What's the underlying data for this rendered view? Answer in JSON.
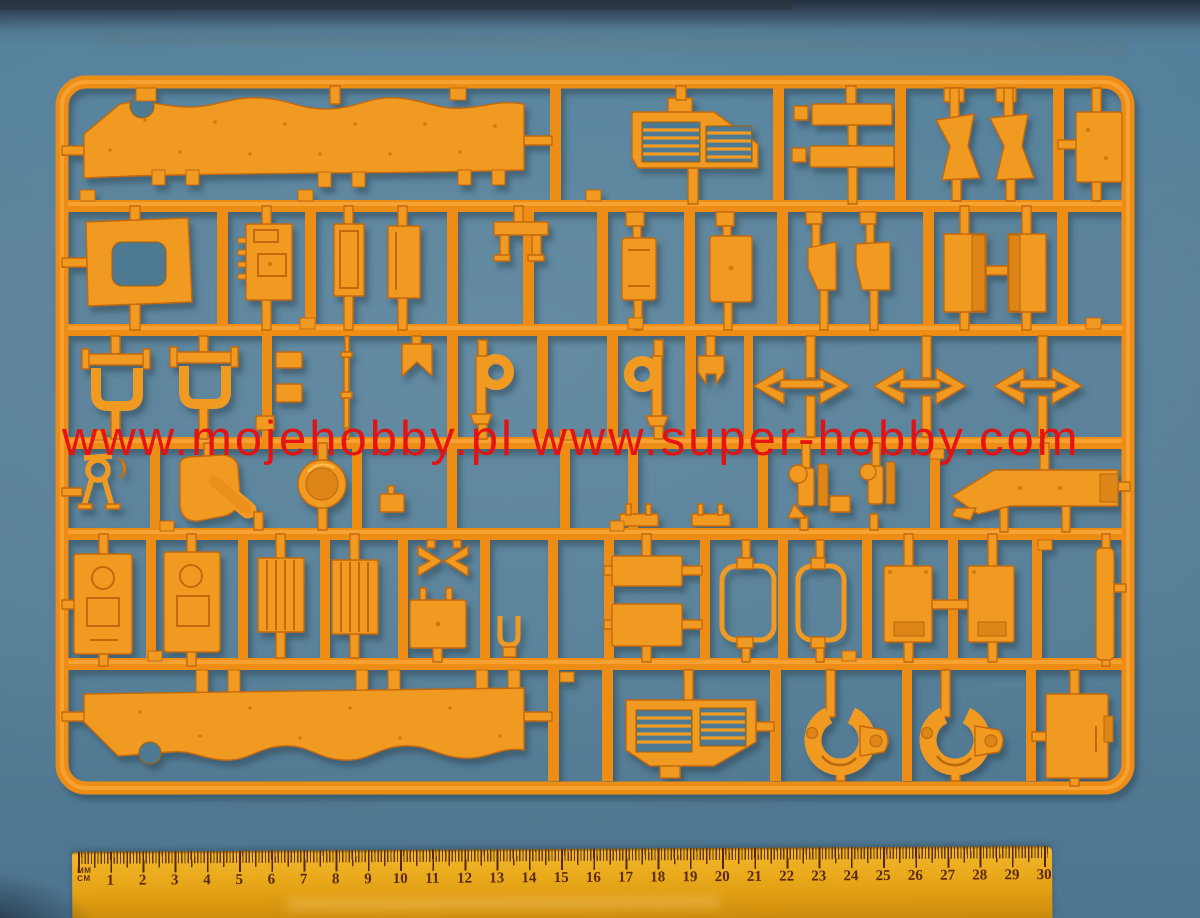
{
  "image_type": "photograph",
  "subject": "Orange plastic model kit sprue (injection-moulded parts frame) lying on a blue surface, photographed from above with a centimeter ruler at the bottom for scale",
  "colors": {
    "background_blue": "#54809a",
    "sprue_orange": "#ee8d18",
    "part_orange": "#f19a24",
    "watermark_red": "#e51111",
    "ruler_yellow": "#e7a61a",
    "ruler_markings": "#5c2a12"
  },
  "watermark": {
    "text": "www.mojehobby.pl www.super-hobby.com"
  },
  "ruler": {
    "unit_top": "MM",
    "unit_bottom": "CM",
    "numbers": [
      "1",
      "2",
      "3",
      "4",
      "5",
      "6",
      "7",
      "8",
      "9",
      "10",
      "11",
      "12",
      "13",
      "14",
      "15",
      "16",
      "17",
      "18",
      "19",
      "20",
      "21",
      "22",
      "23",
      "24",
      "25",
      "26",
      "27",
      "28",
      "29",
      "30"
    ]
  },
  "sprue": {
    "description": "Rectangular orange runner frame with internal grid runners holding model parts",
    "parts": [
      "upper hull side skirt (long wavy strip)",
      "engine intake grille with louvres",
      "two spare track bars",
      "two curved windshield panels",
      "rectangular hull panel",
      "window frame with cutout",
      "detailed equipment box",
      "two vertical panels",
      "small mounting bracket",
      "two access hatches",
      "two angled brackets",
      "two armor blocks",
      "two U-shaped frames",
      "small fittings cluster",
      "thin towing rod",
      "hook bracket",
      "two periscope P-brackets",
      "six tow-hook chevrons",
      "small figure-like fitting",
      "rotary lever assembly",
      "round hatch ring",
      "long pointed fender",
      "two periscope guards",
      "two crew door panels with hatch detail",
      "two ribbed vent panels",
      "two small clamp arrows",
      "storage box with pins",
      "small U-clip",
      "two stacked plates",
      "two open window frames",
      "two solid door panels",
      "narrow side strip",
      "lower engine grille with louvres",
      "two C-shaped tow clamps",
      "equipment box",
      "lower hull side skirt (long wavy strip)"
    ]
  }
}
